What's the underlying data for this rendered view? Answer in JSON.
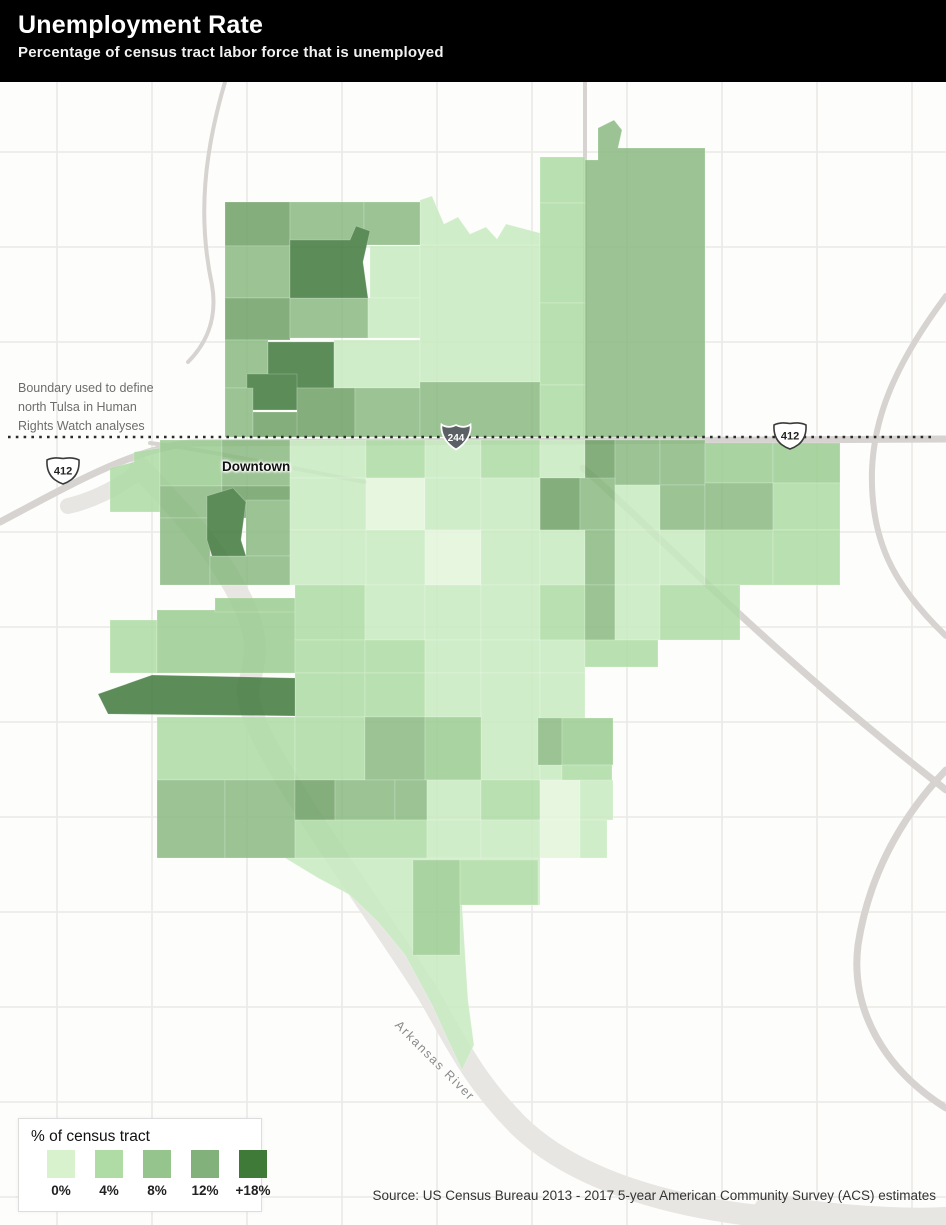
{
  "header": {
    "title": "Unemployment Rate",
    "subtitle": "Percentage of census tract labor force that is unemployed"
  },
  "annotation": {
    "lines": [
      "Boundary used to define",
      "north Tulsa in Human",
      "Rights Watch analyses"
    ]
  },
  "labels": {
    "downtown": "Downtown",
    "river": "Arkansas River"
  },
  "legend": {
    "title": "% of census tract",
    "items": [
      {
        "label": "0%",
        "color": "#d8f2cd"
      },
      {
        "label": "4%",
        "color": "#aedca4"
      },
      {
        "label": "8%",
        "color": "#95c58d"
      },
      {
        "label": "12%",
        "color": "#82b17b"
      },
      {
        "label": "+18%",
        "color": "#3f7a38"
      }
    ]
  },
  "source": "Source: US Census Bureau 2013 - 2017 5-year American Community Survey (ACS) estimates",
  "map": {
    "background": "#fdfdfb",
    "grid_color": "#edebe9",
    "road_color": "#d6d3d1",
    "river_color": "#e8e6e3",
    "boundary_line": {
      "y": 437,
      "x1": 8,
      "x2": 934,
      "color": "#2b2b2b"
    },
    "palette": {
      "L0": "#e3f5db",
      "L1": "#c9ebc1",
      "L2": "#aedca4",
      "M1": "#9bcd92",
      "M2": "#8aba81",
      "M3": "#6fa267",
      "D": "#41793c"
    },
    "grid": {
      "v": [
        57,
        152,
        247,
        342,
        437,
        532,
        627,
        722,
        817,
        912
      ],
      "h": [
        152,
        247,
        342,
        532,
        627,
        722,
        817,
        912,
        1007,
        1102,
        1197
      ]
    },
    "roads": [
      {
        "d": "M0,522 C70,485 130,450 190,443 L946,439",
        "w": 7
      },
      {
        "d": "M583,468 C650,525 760,645 946,790",
        "w": 7
      },
      {
        "d": "M946,296 C892,368 874,420 872,470 C870,540 893,585 946,636",
        "w": 6
      },
      {
        "d": "M946,770 C898,820 868,880 858,945 C850,1010 885,1070 946,1108",
        "w": 7
      },
      {
        "d": "M225,82 C205,150 197,215 212,285 C218,320 205,345 188,362",
        "w": 4
      },
      {
        "d": "M150,443 C220,452 300,470 365,482",
        "w": 4
      },
      {
        "d": "M585,440 L585,82",
        "w": 4
      }
    ],
    "river": [
      {
        "d": "M140,468 C170,500 212,542 240,597 C262,640 255,660 248,688 C246,715 272,757 307,812 C340,864 382,922 427,992 C455,1040 472,1078 517,1124 C567,1174 652,1202 742,1214 C832,1224 900,1226 946,1226",
        "w": 22
      },
      {
        "d": "M142,470 C120,486 95,500 68,506",
        "w": 16
      },
      {
        "d": "M770,1212 C850,1224 910,1226 946,1224",
        "w": 34
      }
    ],
    "tracts": {
      "base_polys": [
        {
          "c": "M2",
          "pts": [
            [
              585,
              160
            ],
            [
              598,
              160
            ],
            [
              598,
              128
            ],
            [
              614,
              120
            ],
            [
              622,
              130
            ],
            [
              618,
              148
            ],
            [
              705,
              148
            ],
            [
              705,
              437
            ],
            [
              585,
              437
            ]
          ]
        },
        {
          "c": "L1",
          "pts": [
            [
              420,
              200
            ],
            [
              432,
              196
            ],
            [
              444,
              224
            ],
            [
              458,
              217
            ],
            [
              470,
              234
            ],
            [
              486,
              227
            ],
            [
              497,
              239
            ],
            [
              506,
              224
            ],
            [
              540,
              233
            ],
            [
              540,
              247
            ],
            [
              420,
              247
            ]
          ]
        },
        {
          "c": "L2",
          "pts": [
            [
              110,
              468
            ],
            [
              134,
              462
            ],
            [
              134,
              452
            ],
            [
              160,
              448
            ],
            [
              160,
              512
            ],
            [
              110,
              512
            ]
          ]
        },
        {
          "c": "L1",
          "pts": [
            [
              285,
              858
            ],
            [
              540,
              858
            ],
            [
              540,
              905
            ],
            [
              462,
              905
            ],
            [
              468,
              1000
            ],
            [
              474,
              1045
            ],
            [
              462,
              1070
            ],
            [
              448,
              1040
            ],
            [
              432,
              1005
            ],
            [
              405,
              955
            ],
            [
              378,
              922
            ],
            [
              350,
              895
            ],
            [
              318,
              878
            ]
          ]
        }
      ],
      "rects": [
        [
          225,
          202,
          65,
          44,
          "M3"
        ],
        [
          290,
          202,
          74,
          44,
          "M2"
        ],
        [
          364,
          202,
          56,
          43,
          "M2"
        ],
        [
          225,
          246,
          65,
          52,
          "M2"
        ],
        [
          370,
          246,
          50,
          52,
          "L1"
        ],
        [
          225,
          298,
          65,
          42,
          "M3"
        ],
        [
          290,
          298,
          78,
          40,
          "M2"
        ],
        [
          368,
          298,
          52,
          40,
          "L1"
        ],
        [
          225,
          340,
          43,
          48,
          "M2"
        ],
        [
          268,
          342,
          66,
          46,
          "D"
        ],
        [
          247,
          374,
          50,
          36,
          "D"
        ],
        [
          334,
          340,
          86,
          48,
          "L1"
        ],
        [
          225,
          388,
          28,
          49,
          "M2"
        ],
        [
          253,
          412,
          47,
          25,
          "M3"
        ],
        [
          297,
          388,
          58,
          49,
          "M3"
        ],
        [
          355,
          388,
          65,
          49,
          "M2"
        ],
        [
          420,
          245,
          120,
          137,
          "L1"
        ],
        [
          540,
          157,
          45,
          46,
          "L2"
        ],
        [
          540,
          203,
          45,
          100,
          "L2"
        ],
        [
          540,
          303,
          45,
          82,
          "L2"
        ],
        [
          420,
          382,
          120,
          55,
          "M2"
        ],
        [
          540,
          385,
          45,
          52,
          "L2"
        ],
        [
          160,
          440,
          62,
          46,
          "M1"
        ],
        [
          222,
          440,
          68,
          46,
          "M2"
        ],
        [
          160,
          486,
          62,
          32,
          "M2"
        ],
        [
          222,
          486,
          68,
          32,
          "M3"
        ],
        [
          290,
          440,
          76,
          38,
          "L1"
        ],
        [
          366,
          440,
          59,
          38,
          "L2"
        ],
        [
          425,
          440,
          56,
          38,
          "L1"
        ],
        [
          481,
          440,
          59,
          38,
          "L2"
        ],
        [
          540,
          440,
          45,
          38,
          "L1"
        ],
        [
          585,
          440,
          30,
          45,
          "M3"
        ],
        [
          615,
          440,
          45,
          45,
          "M2"
        ],
        [
          660,
          440,
          45,
          45,
          "M2"
        ],
        [
          705,
          443,
          68,
          40,
          "M1"
        ],
        [
          773,
          443,
          67,
          40,
          "M1"
        ],
        [
          540,
          478,
          40,
          52,
          "M3"
        ],
        [
          580,
          478,
          35,
          52,
          "M2"
        ],
        [
          615,
          485,
          45,
          45,
          "L1"
        ],
        [
          660,
          485,
          45,
          45,
          "M2"
        ],
        [
          705,
          483,
          68,
          47,
          "M2"
        ],
        [
          773,
          483,
          67,
          47,
          "L2"
        ],
        [
          246,
          500,
          44,
          56,
          "M2"
        ],
        [
          290,
          478,
          76,
          52,
          "L1"
        ],
        [
          366,
          478,
          59,
          52,
          "L0"
        ],
        [
          425,
          478,
          56,
          52,
          "L1"
        ],
        [
          481,
          478,
          59,
          52,
          "L1"
        ],
        [
          160,
          518,
          50,
          67,
          "M2"
        ],
        [
          210,
          556,
          80,
          29,
          "M2"
        ],
        [
          290,
          530,
          76,
          55,
          "L1"
        ],
        [
          366,
          530,
          59,
          55,
          "L1"
        ],
        [
          425,
          530,
          56,
          55,
          "L0"
        ],
        [
          481,
          530,
          59,
          55,
          "L1"
        ],
        [
          540,
          530,
          45,
          55,
          "L1"
        ],
        [
          585,
          530,
          30,
          55,
          "M2"
        ],
        [
          615,
          530,
          45,
          55,
          "L1"
        ],
        [
          660,
          530,
          45,
          55,
          "L1"
        ],
        [
          705,
          530,
          68,
          55,
          "L2"
        ],
        [
          773,
          530,
          67,
          55,
          "L2"
        ],
        [
          110,
          620,
          47,
          53,
          "L2"
        ],
        [
          157,
          610,
          138,
          63,
          "M1"
        ],
        [
          215,
          598,
          80,
          14,
          "M1"
        ],
        [
          295,
          585,
          70,
          55,
          "L2"
        ],
        [
          365,
          585,
          60,
          55,
          "L1"
        ],
        [
          425,
          585,
          56,
          55,
          "L1"
        ],
        [
          481,
          585,
          59,
          55,
          "L1"
        ],
        [
          540,
          585,
          45,
          55,
          "L2"
        ],
        [
          585,
          585,
          30,
          55,
          "M2"
        ],
        [
          615,
          585,
          45,
          55,
          "L1"
        ],
        [
          660,
          585,
          80,
          55,
          "L2"
        ],
        [
          295,
          640,
          70,
          33,
          "L2"
        ],
        [
          365,
          640,
          60,
          33,
          "L2"
        ],
        [
          425,
          640,
          56,
          33,
          "L1"
        ],
        [
          481,
          640,
          59,
          33,
          "L1"
        ],
        [
          540,
          640,
          45,
          33,
          "L1"
        ],
        [
          585,
          640,
          73,
          27,
          "L2"
        ],
        [
          295,
          673,
          70,
          44,
          "L2"
        ],
        [
          365,
          673,
          60,
          44,
          "L2"
        ],
        [
          425,
          673,
          56,
          44,
          "L1"
        ],
        [
          481,
          673,
          59,
          107,
          "L1"
        ],
        [
          540,
          673,
          45,
          107,
          "L1"
        ],
        [
          538,
          718,
          24,
          47,
          "M2"
        ],
        [
          562,
          718,
          51,
          47,
          "M1"
        ],
        [
          562,
          765,
          50,
          48,
          "L2"
        ],
        [
          157,
          717,
          138,
          63,
          "L2"
        ],
        [
          295,
          717,
          70,
          63,
          "L2"
        ],
        [
          365,
          717,
          60,
          63,
          "M2"
        ],
        [
          425,
          717,
          56,
          63,
          "M1"
        ],
        [
          157,
          780,
          68,
          78,
          "M2"
        ],
        [
          225,
          780,
          70,
          78,
          "M2"
        ],
        [
          295,
          780,
          40,
          40,
          "M3"
        ],
        [
          335,
          780,
          60,
          40,
          "M2"
        ],
        [
          395,
          780,
          32,
          40,
          "M2"
        ],
        [
          295,
          820,
          132,
          38,
          "L2"
        ],
        [
          427,
          780,
          54,
          40,
          "L1"
        ],
        [
          481,
          780,
          59,
          40,
          "L2"
        ],
        [
          540,
          780,
          40,
          40,
          "L0"
        ],
        [
          580,
          780,
          33,
          40,
          "L1"
        ],
        [
          427,
          820,
          54,
          38,
          "L1"
        ],
        [
          481,
          820,
          59,
          38,
          "L1"
        ],
        [
          540,
          820,
          40,
          38,
          "L0"
        ],
        [
          580,
          820,
          27,
          38,
          "L1"
        ],
        [
          413,
          860,
          47,
          95,
          "M1"
        ],
        [
          460,
          860,
          78,
          45,
          "L2"
        ]
      ],
      "top_polys": [
        {
          "c": "D",
          "pts": [
            [
              290,
              240
            ],
            [
              350,
              240
            ],
            [
              356,
              226
            ],
            [
              370,
              231
            ],
            [
              363,
              262
            ],
            [
              368,
              298
            ],
            [
              290,
              298
            ]
          ]
        },
        {
          "c": "D",
          "pts": [
            [
              207,
              496
            ],
            [
              233,
              488
            ],
            [
              246,
              502
            ],
            [
              241,
              540
            ],
            [
              246,
              556
            ],
            [
              212,
              556
            ],
            [
              207,
              540
            ]
          ]
        },
        {
          "c": "D",
          "pts": [
            [
              98,
              694
            ],
            [
              152,
              675
            ],
            [
              295,
              678
            ],
            [
              295,
              716
            ],
            [
              108,
              714
            ]
          ]
        }
      ]
    },
    "shields": [
      {
        "kind": "us",
        "label": "412",
        "cx": 63,
        "cy": 470
      },
      {
        "kind": "i",
        "label": "244",
        "cx": 456,
        "cy": 437
      },
      {
        "kind": "us",
        "label": "412",
        "cx": 790,
        "cy": 435
      }
    ]
  }
}
